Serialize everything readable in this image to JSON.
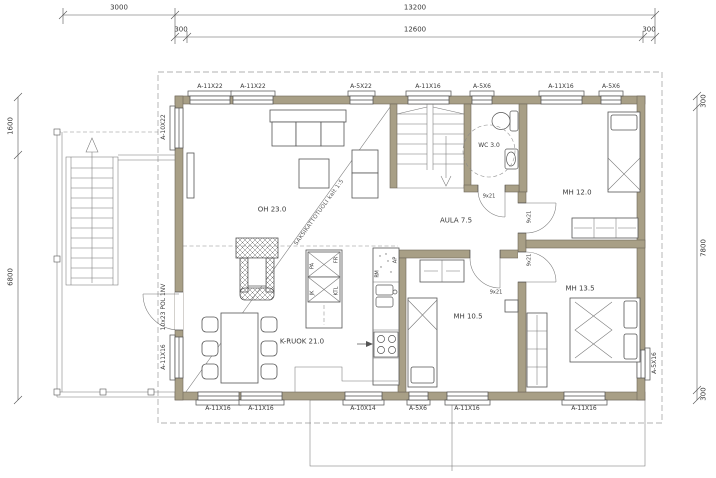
{
  "dimensions": {
    "top_row1": [
      "3000",
      "13200"
    ],
    "top_row2": [
      "300",
      "12600",
      "300"
    ],
    "left": [
      "1600",
      "6800"
    ],
    "right": [
      "300",
      "7800",
      "300"
    ]
  },
  "rooms": {
    "living": "OH 23.0",
    "kitchen_dining": "K-RUOK 21.0",
    "hall": "AULA 7.5",
    "wc": "WC 3.0",
    "bedroom_a": "MH 12.0",
    "bedroom_b": "MH 13.5",
    "bedroom_c": "MH 10.5"
  },
  "windows": {
    "top": [
      "A-11X22",
      "A-11X22",
      "A-5X22",
      "A-11X16",
      "A-5X6",
      "A-11X16",
      "A-5X6"
    ],
    "bottom": [
      "A-11X16",
      "A-11X16",
      "A-10X14",
      "A-5X6",
      "A-11X16",
      "A-11X16"
    ],
    "left": [
      "A-10X22",
      "A-11X16"
    ],
    "right": [
      "A-5X16"
    ]
  },
  "doors": {
    "entry": "10x23 POL 1NV",
    "wc": "9x21",
    "bedroom_a": "9x21",
    "bedroom_b": "9x21",
    "bedroom_c": "9x21"
  },
  "appliances": {
    "pa": "PA",
    "jk": "JK",
    "fr": "FR",
    "ktl": "KTL",
    "pm": "PM",
    "ap": "AP"
  },
  "annotations": {
    "truss_note": "SAKSIKATTOTUOLI kalt 1:5"
  },
  "colors": {
    "wall": "#a89f86",
    "line": "#4d4d4d",
    "dash": "#999999"
  }
}
